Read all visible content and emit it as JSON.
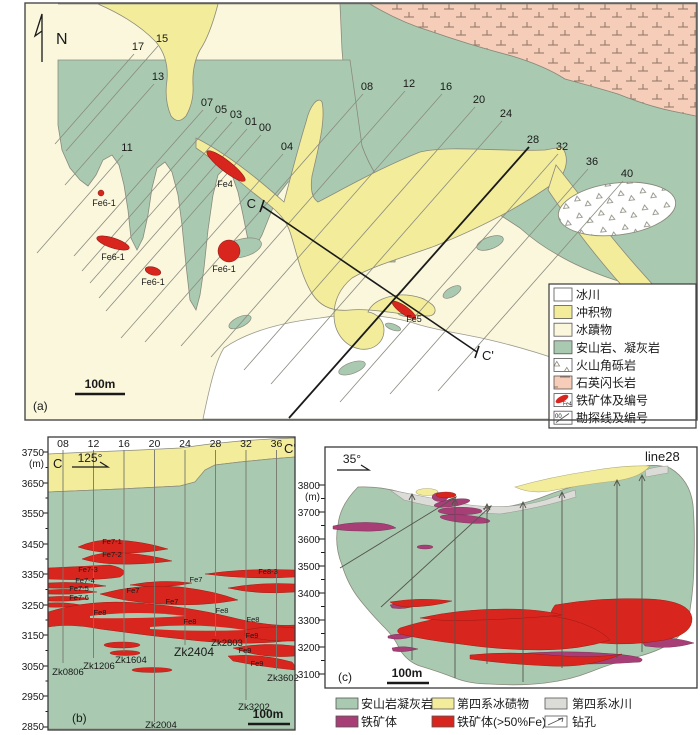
{
  "a": {
    "tag": "(a)",
    "north": "N",
    "scale": "100m",
    "c": "C",
    "cp": "C'",
    "lines": [
      "17",
      "15",
      "13",
      "11",
      "07",
      "05",
      "03",
      "01",
      "00",
      "04",
      "08",
      "12",
      "16",
      "20",
      "24",
      "28",
      "32",
      "36",
      "40"
    ],
    "ores": [
      "Fe6-1",
      "Fe6-1",
      "Fe6-1",
      "Fe6-1",
      "Fe4",
      "Fe5"
    ],
    "legend": [
      "冰川",
      "冲积物",
      "冰蹟物",
      "安山岩、凝灰岩",
      "火山角砾岩",
      "石英闪长岩",
      "铁矿体及编号",
      "勘探线及编号"
    ],
    "legend_ore": "Fe4",
    "legend_line": "00"
  },
  "b": {
    "tag": "(b)",
    "c": "C",
    "cp": "C'",
    "az": "125°",
    "scale": "100m",
    "unit": "(m)",
    "elev": [
      "3750",
      "3650",
      "3550",
      "3450",
      "3350",
      "3250",
      "3150",
      "3050",
      "2950",
      "2850"
    ],
    "lines": [
      "08",
      "12",
      "16",
      "20",
      "24",
      "28",
      "32",
      "36"
    ],
    "ores": [
      "Fe7-1",
      "Fe7-2",
      "Fe7-3",
      "Fe7-4",
      "Fe7-5",
      "Fe7-6",
      "Fe7",
      "Fe7",
      "Fe7",
      "Fe8",
      "Fe8",
      "Fe8",
      "Fe8",
      "Fe8-3",
      "Fe9",
      "Fe9",
      "Fe9"
    ],
    "holes": [
      "Zk0806",
      "Zk1206",
      "Zk1604",
      "Zk2404",
      "Zk2803",
      "Zk3602",
      "Zk3202",
      "Zk2004"
    ]
  },
  "c": {
    "tag": "(c)",
    "title": "line28",
    "az": "35°",
    "scale": "100m",
    "unit": "(m)",
    "elev": [
      "3800",
      "3700",
      "3600",
      "3500",
      "3400",
      "3300",
      "3200",
      "3100"
    ]
  },
  "legend2": [
    "安山岩凝灰岩",
    "第四系冰碛物",
    "第四系冰川",
    "铁矿体",
    "铁矿体(>50%Fe)",
    "钻孔"
  ],
  "colors": {
    "green": "#A9CAB1",
    "yellow": "#F2EC9B",
    "cream": "#FAF7DC",
    "pink": "#F6CDB8",
    "red": "#D8251D",
    "purple": "#A73F76",
    "gray": "#DBDBD7",
    "white": "#FFFFFF"
  }
}
